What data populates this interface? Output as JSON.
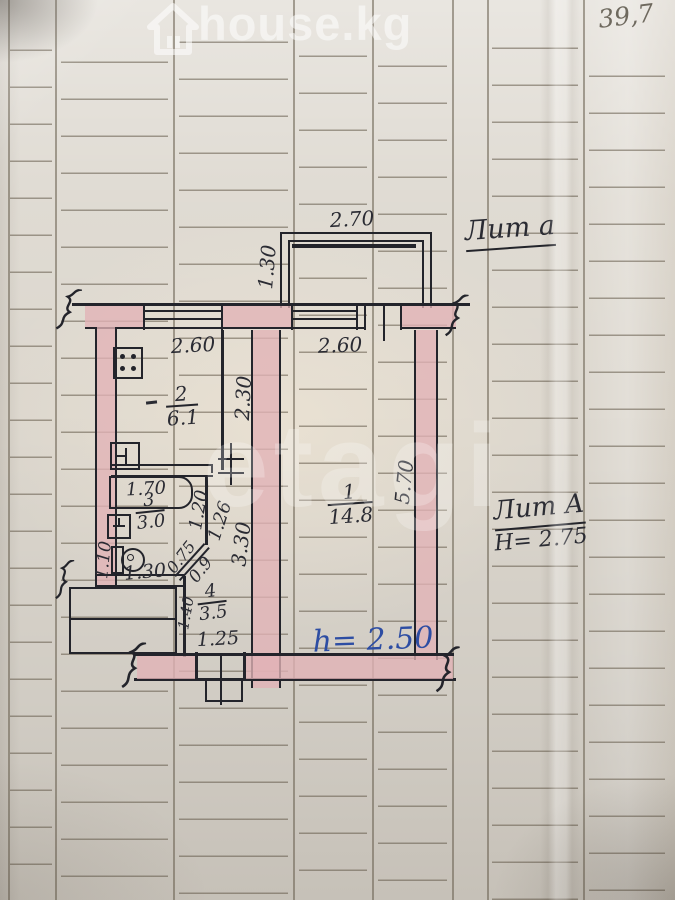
{
  "page": {
    "corner_note": "39,7"
  },
  "watermarks": {
    "top_brand": "house.kg",
    "center_brand": "etagi",
    "house_icon": "house-outline"
  },
  "plan": {
    "balcony": {
      "label_lit": "Лит а",
      "width": "2.70",
      "depth": "1.30"
    },
    "kitchen": {
      "number": "2",
      "area": "6.1",
      "width": "2.60",
      "depth": "2.30"
    },
    "bathroom": {
      "number": "3",
      "area": "3.0",
      "bath_length": "1.70",
      "dim_right_upper": "1.20",
      "dim_right_lower": "1.26",
      "dim_left": "1.10",
      "dim_bottom": "1.30",
      "door_width": "0.75",
      "door_leaf": "0.9"
    },
    "hallway": {
      "number": "4",
      "area": "3.5",
      "dim_left": "1.40",
      "dim_bottom": "1.25"
    },
    "room1": {
      "number": "1",
      "area": "14.8",
      "width": "2.60",
      "depth": "5.70",
      "wall_dim": "3.30"
    },
    "notes": {
      "lit_main": "Лит А",
      "building_height": "Н= 2.75",
      "ceiling_height": "h= 2.50"
    }
  },
  "colors": {
    "paper": "#dcd7ce",
    "wall_fill": "#e1b2b6",
    "ink": "#23242b",
    "blue_ink": "#2d4da3",
    "pencil": "#6e695e",
    "watermark": "#ffffff"
  }
}
